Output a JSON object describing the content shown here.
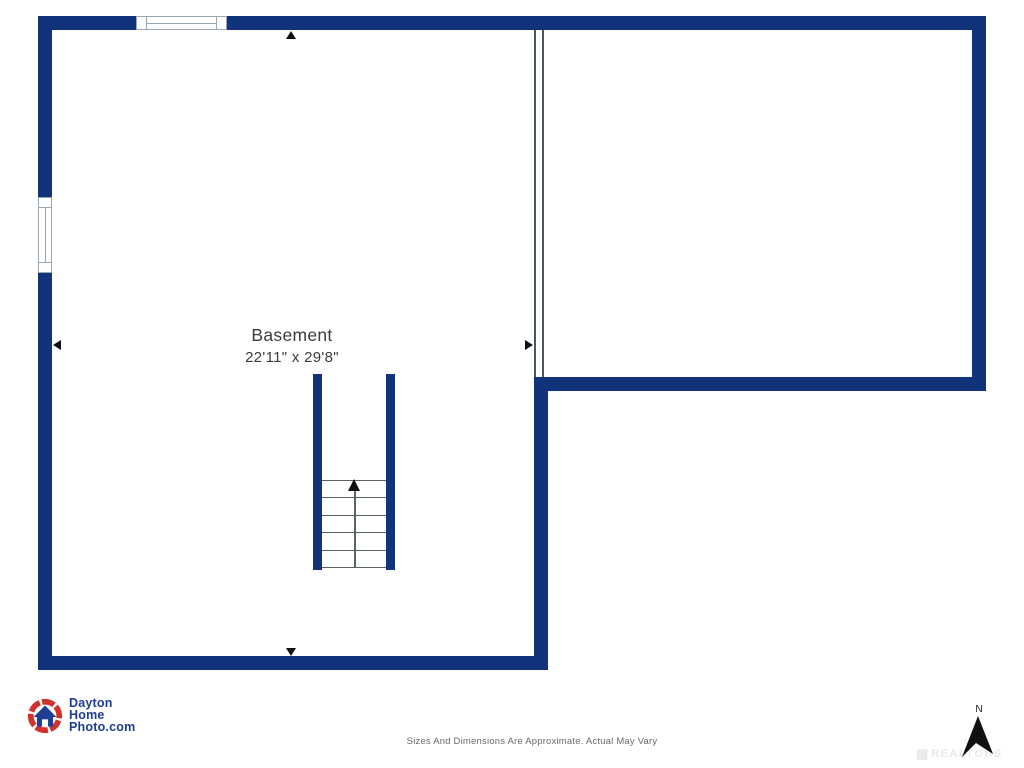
{
  "floorplan": {
    "room": {
      "name": "Basement",
      "dimensions": "22'11\" x 29'8\""
    }
  },
  "footer": {
    "logo": {
      "line1": "Dayton",
      "line2": "Home",
      "line3": "Photo.com"
    },
    "disclaimer": "Sizes And Dimensions Are Approximate. Actual May Vary",
    "compass_label": "N",
    "watermark": "REALTORS"
  },
  "colors": {
    "wall": "#10337C",
    "thin_line": "#4E565E",
    "step_line": "#5A6468",
    "window_line": "#9AA6B4",
    "label_text": "#3B3B3B",
    "logo_navy": "#1D3E92",
    "logo_red": "#D2302C",
    "disclaimer_text": "#6A6A6A"
  }
}
